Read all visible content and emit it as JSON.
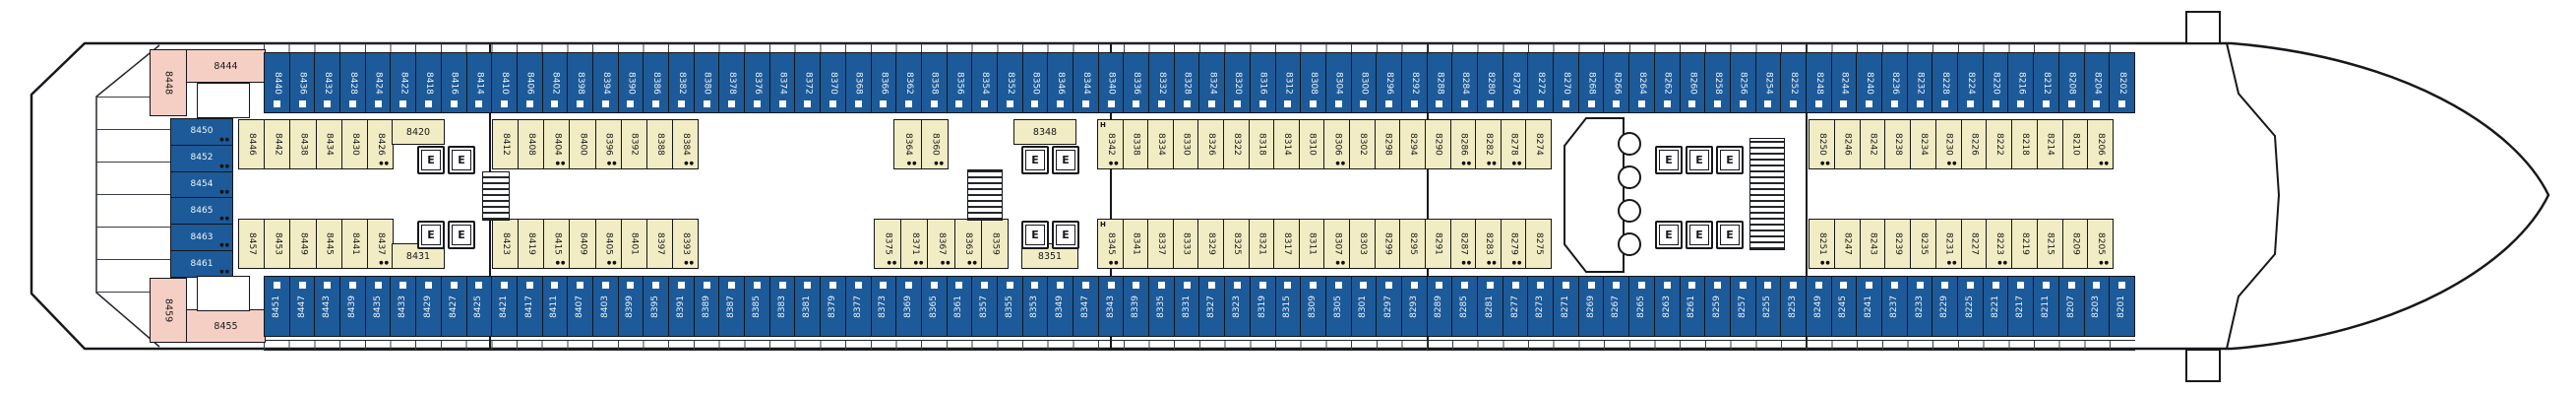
{
  "deck": {
    "colors": {
      "balcony_cabin_blue": "#1d5a99",
      "inside_cabin_cream": "#f1ecc3",
      "aft_suite_pink": "#f6cfc4",
      "outline_black": "#17181c",
      "background": "#ffffff"
    },
    "elevator_label": "E",
    "accessible_label": "H",
    "berth_dots_glyph": "●●",
    "rows": {
      "top_outer_balcony": [
        "8440",
        "8436",
        "8432",
        "8428",
        "8424",
        "8422",
        "8418",
        "8416",
        "8414",
        "8410",
        "8406",
        "8402",
        "8398",
        "8394",
        "8390",
        "8386",
        "8382",
        "8380",
        "8378",
        "8376",
        "8374",
        "8372",
        "8370",
        "8368",
        "8366",
        "8362",
        "8358",
        "8356",
        "8354",
        "8352",
        "8350",
        "8346",
        "8344",
        "8340",
        "8336",
        "8332",
        "8328",
        "8324",
        "8320",
        "8316",
        "8312",
        "8308",
        "8304",
        "8300",
        "8296",
        "8292",
        "8288",
        "8284",
        "8280",
        "8276",
        "8272",
        "8270",
        "8268",
        "8266",
        "8264",
        "8262",
        "8260",
        "8258",
        "8256",
        "8254",
        "8252",
        "8248",
        "8244",
        "8240",
        "8236",
        "8232",
        "8228",
        "8224",
        "8220",
        "8216",
        "8212",
        "8208",
        "8204",
        "8202"
      ],
      "bottom_outer_balcony": [
        "8451",
        "8447",
        "8443",
        "8439",
        "8435",
        "8433",
        "8429",
        "8427",
        "8425",
        "8421",
        "8417",
        "8411",
        "8407",
        "8403",
        "8399",
        "8395",
        "8391",
        "8389",
        "8387",
        "8385",
        "8383",
        "8381",
        "8379",
        "8377",
        "8373",
        "8369",
        "8365",
        "8361",
        "8357",
        "8355",
        "8353",
        "8349",
        "8347",
        "8343",
        "8339",
        "8335",
        "8331",
        "8327",
        "8323",
        "8319",
        "8315",
        "8309",
        "8305",
        "8301",
        "8297",
        "8293",
        "8289",
        "8285",
        "8281",
        "8277",
        "8273",
        "8271",
        "8269",
        "8267",
        "8265",
        "8263",
        "8261",
        "8259",
        "8257",
        "8255",
        "8253",
        "8249",
        "8245",
        "8241",
        "8237",
        "8233",
        "8229",
        "8225",
        "8221",
        "8217",
        "8211",
        "8207",
        "8203",
        "8201"
      ],
      "stern_column": [
        "8450",
        "8452",
        "8454",
        "8465",
        "8463",
        "8461"
      ],
      "stern_pink": {
        "top_vertical": "8448",
        "top_wide": "8444",
        "bottom_vertical": "8459",
        "bottom_wide": "8455"
      },
      "inner_upper": {
        "aft_block": [
          "8446",
          "8442",
          "8438",
          "8434",
          "8430",
          "8426"
        ],
        "aft_wide": "8420",
        "mid_aft_block": [
          "8412",
          "8408",
          "8404",
          "8400",
          "8396",
          "8392",
          "8388",
          "8384"
        ],
        "mid_pair": [
          "8364",
          "8360"
        ],
        "mid_wide": "8348",
        "forward_block": [
          "8342",
          "8338",
          "8334",
          "8330",
          "8326",
          "8322",
          "8318",
          "8314",
          "8310",
          "8306",
          "8302",
          "8298",
          "8294",
          "8290",
          "8286",
          "8282",
          "8278",
          "8274"
        ],
        "bow_block": [
          "8250",
          "8246",
          "8242",
          "8238",
          "8234",
          "8230",
          "8226",
          "8222",
          "8218",
          "8214",
          "8210",
          "8206"
        ]
      },
      "inner_lower": {
        "aft_block": [
          "8457",
          "8453",
          "8449",
          "8445",
          "8441",
          "8437"
        ],
        "aft_wide": "8431",
        "mid_aft_block": [
          "8423",
          "8419",
          "8415",
          "8409",
          "8405",
          "8401",
          "8397",
          "8393"
        ],
        "mid_block": [
          "8375",
          "8371",
          "8367",
          "8363",
          "8359"
        ],
        "mid_wide": "8351",
        "forward_block": [
          "8345",
          "8341",
          "8337",
          "8333",
          "8329",
          "8325",
          "8321",
          "8317",
          "8311",
          "8307",
          "8303",
          "8299",
          "8295",
          "8291",
          "8287",
          "8283",
          "8279",
          "8275"
        ],
        "bow_block": [
          "8251",
          "8247",
          "8243",
          "8239",
          "8235",
          "8231",
          "8227",
          "8223",
          "8219",
          "8215",
          "8209",
          "8205"
        ]
      },
      "cabins_with_berth_dots": [
        "8426",
        "8404",
        "8396",
        "8384",
        "8364",
        "8360",
        "8342",
        "8306",
        "8286",
        "8282",
        "8278",
        "8250",
        "8230",
        "8206",
        "8437",
        "8415",
        "8405",
        "8393",
        "8375",
        "8371",
        "8367",
        "8363",
        "8345",
        "8307",
        "8287",
        "8283",
        "8279",
        "8251",
        "8231",
        "8223",
        "8205",
        "8450",
        "8452",
        "8454",
        "8465",
        "8463",
        "8461"
      ],
      "cabins_with_h": [
        "8342",
        "8345"
      ]
    }
  }
}
